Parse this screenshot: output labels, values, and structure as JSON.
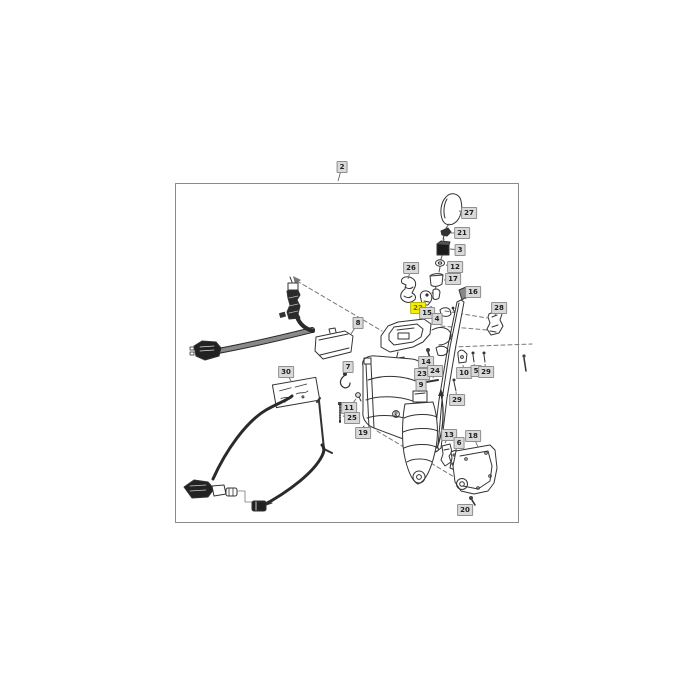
{
  "page": {
    "background": "#ffffff"
  },
  "diagram": {
    "type": "exploded-parts-diagram",
    "assembly_box_label": "2",
    "selected_part": "22",
    "colors": {
      "line": "#333333",
      "dashed_line": "#777777",
      "border": "#8a8a8a",
      "callout_bg": "#d9d9d9",
      "callout_border": "#8f8f8f",
      "callout_text": "#1f1f1f",
      "highlight_bg": "#f5ee00",
      "highlight_border": "#b9b400",
      "highlight_text": "#6d6d12"
    },
    "callouts": [
      {
        "label": "2",
        "x": 342,
        "y": 167,
        "highlighted": false,
        "leader": [
          338,
          181
        ]
      },
      {
        "label": "27",
        "x": 469,
        "y": 213,
        "highlighted": false,
        "leader": [
          459,
          211
        ]
      },
      {
        "label": "21",
        "x": 462,
        "y": 233,
        "highlighted": false,
        "leader": [
          451,
          233
        ]
      },
      {
        "label": "3",
        "x": 460,
        "y": 250,
        "highlighted": false,
        "leader": [
          450,
          249
        ]
      },
      {
        "label": "12",
        "x": 455,
        "y": 267,
        "highlighted": false,
        "leader": [
          446,
          265
        ]
      },
      {
        "label": "17",
        "x": 453,
        "y": 279,
        "highlighted": false,
        "leader": [
          444,
          280
        ]
      },
      {
        "label": "26",
        "x": 411,
        "y": 268,
        "highlighted": false,
        "leader": [
          408,
          279
        ]
      },
      {
        "label": "16",
        "x": 473,
        "y": 292,
        "highlighted": false,
        "leader": [
          465,
          299
        ]
      },
      {
        "label": "28",
        "x": 499,
        "y": 308,
        "highlighted": false,
        "leader": [
          495,
          315
        ]
      },
      {
        "label": "22",
        "x": 418,
        "y": 308,
        "highlighted": true,
        "leader": [
          424,
          304
        ]
      },
      {
        "label": "15",
        "x": 427,
        "y": 313,
        "highlighted": false,
        "leader": [
          430,
          309
        ]
      },
      {
        "label": "4",
        "x": 437,
        "y": 319,
        "highlighted": false,
        "leader": [
          440,
          315
        ]
      },
      {
        "label": "8",
        "x": 358,
        "y": 323,
        "highlighted": false,
        "leader": [
          351,
          334
        ]
      },
      {
        "label": "30",
        "x": 286,
        "y": 372,
        "highlighted": false,
        "leader": [
          291,
          381
        ]
      },
      {
        "label": "7",
        "x": 348,
        "y": 367,
        "highlighted": false,
        "leader": [
          346,
          373
        ]
      },
      {
        "label": "14",
        "x": 426,
        "y": 362,
        "highlighted": false,
        "leader": [
          429,
          356
        ]
      },
      {
        "label": "23",
        "x": 422,
        "y": 374,
        "highlighted": false,
        "leader": [
          422,
          379
        ]
      },
      {
        "label": "24",
        "x": 435,
        "y": 371,
        "highlighted": false,
        "leader": [
          433,
          378
        ]
      },
      {
        "label": "9",
        "x": 421,
        "y": 385,
        "highlighted": false,
        "leader": [
          419,
          392
        ]
      },
      {
        "label": "10",
        "x": 464,
        "y": 373,
        "highlighted": false,
        "leader": [
          463,
          365
        ]
      },
      {
        "label": "5",
        "x": 476,
        "y": 371,
        "highlighted": false,
        "leader": [
          474,
          364
        ]
      },
      {
        "label": "29",
        "x": 486,
        "y": 372,
        "highlighted": false,
        "leader": [
          485,
          364
        ]
      },
      {
        "label": "29",
        "x": 457,
        "y": 400,
        "highlighted": false,
        "leader": [
          456,
          392
        ]
      },
      {
        "label": "11",
        "x": 349,
        "y": 408,
        "highlighted": false,
        "leader": [
          356,
          399
        ]
      },
      {
        "label": "25",
        "x": 352,
        "y": 418,
        "highlighted": false,
        "leader": [
          343,
          416
        ]
      },
      {
        "label": "19",
        "x": 363,
        "y": 433,
        "highlighted": false,
        "leader": [
          372,
          426
        ]
      },
      {
        "label": "13",
        "x": 449,
        "y": 435,
        "highlighted": false,
        "leader": [
          445,
          443
        ]
      },
      {
        "label": "18",
        "x": 473,
        "y": 436,
        "highlighted": false,
        "leader": [
          478,
          447
        ]
      },
      {
        "label": "6",
        "x": 459,
        "y": 443,
        "highlighted": false,
        "leader": [
          456,
          450
        ]
      },
      {
        "label": "20",
        "x": 465,
        "y": 510,
        "highlighted": false,
        "leader": [
          470,
          504
        ]
      }
    ]
  }
}
